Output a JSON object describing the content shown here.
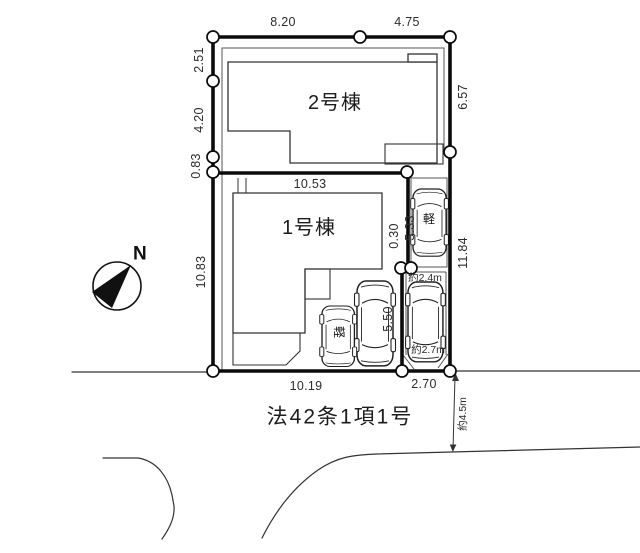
{
  "compass": {
    "north_label": "N"
  },
  "buildings": [
    {
      "name": "2号棟"
    },
    {
      "name": "1号棟"
    }
  ],
  "road": {
    "label": "法42条1項1号",
    "width_label": "約4.5m"
  },
  "cars": [
    {
      "type_label": "軽"
    },
    {
      "type_label": "軽"
    }
  ],
  "dimensions": {
    "top_left_segment": "8.20",
    "top_right_segment": "4.75",
    "left_1": "2.51",
    "left_2": "4.20",
    "left_3": "0.83",
    "left_4": "10.83",
    "right_upper": "6.57",
    "right_lower": "11.84",
    "inner_horizontal": "10.53",
    "building_gap": "0.30",
    "parking_right_length": "5.33",
    "parking_middle_length": "5.50",
    "parking_width_top": "約2.4m",
    "parking_width_bottom": "約2.7m",
    "bottom_left_segment": "10.19",
    "bottom_right_segment": "2.70"
  }
}
